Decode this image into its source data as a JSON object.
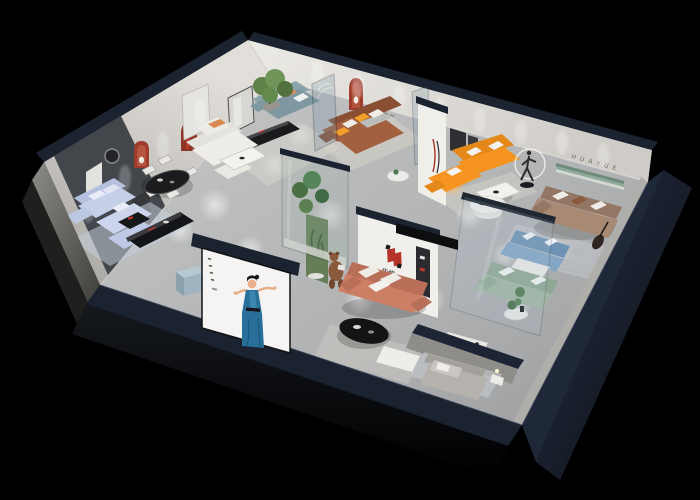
{
  "scene": {
    "description": "Isometric cutaway 3D render of a furniture showroom apartment on a black background",
    "background_color": "#000000",
    "brand": {
      "logo_text": "华悦",
      "wall_letters": "H U A Y U E"
    },
    "palette": {
      "floor": "#b7b9ba",
      "outer_wall_navy": "#1b2330",
      "back_wall": "#ddd9d4",
      "accent_wall_dark": "#43464b",
      "arch_red": "#9e3b2d",
      "orange_sofa": "#f59420",
      "brown_sofa": "#a2603e",
      "salmon_sofa": "#cd7f66",
      "lavender_sofa": "#c6cfe8",
      "teal_sofa": "#7e97a0",
      "taupe_sofa": "#a88973",
      "sage_sofa": "#9fb5a2",
      "blue_sofa": "#84a6c4",
      "green_display_band": "#8fa99b",
      "poster_dress_blue": "#2a6f99",
      "logo_red": "#b5342a"
    },
    "rooms": [
      {
        "name": "west-living-room",
        "items": "lavender sectional sofa, black media console, dark accent wall"
      },
      {
        "name": "dining-area",
        "items": "black oval table, white chairs, red arched niches"
      },
      {
        "name": "center-lounge",
        "items": "cream modular sofa, slate-teal sofa, potted tree"
      },
      {
        "name": "glass-suite",
        "items": "brown leather corner sofa, glass partitions, red arch niche"
      },
      {
        "name": "orange-showcase",
        "items": "orange corner sofa, marble coffee table, figure sculpture with light ring"
      },
      {
        "name": "east-lounge",
        "items": "taupe three-seat sofa, lettered wall with green display band"
      },
      {
        "name": "green-room",
        "items": "sage green sofa and blue patterned sofa behind a glass wall"
      },
      {
        "name": "brand-bay",
        "items": "salmon sofa under brand logo, plant vitrine, teddy-bear mascot"
      },
      {
        "name": "south-bedroom",
        "items": "gray daybed, striped rug, white side table"
      },
      {
        "name": "front-facade",
        "items": "poster of a dancing woman in a blue dress on the outer wall"
      }
    ]
  }
}
